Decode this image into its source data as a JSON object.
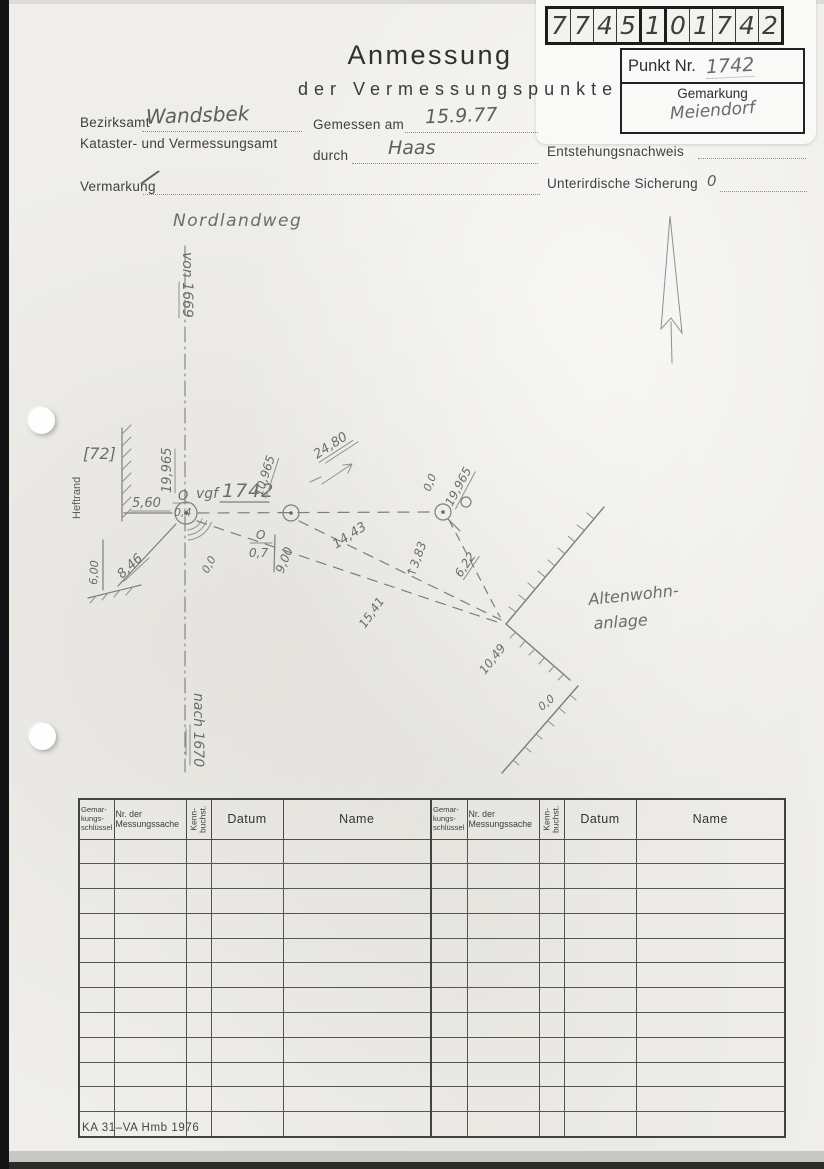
{
  "code_digits": [
    "7",
    "7",
    "4",
    "5",
    "1",
    "0",
    "1",
    "7",
    "4",
    "2"
  ],
  "punkt_box": {
    "label": "Punkt Nr.",
    "value": "1742",
    "gemarkung_label": "Gemarkung",
    "gemarkung_value": "Meiendorf"
  },
  "title": {
    "line1": "Anmessung",
    "line2": "der Vermessungspunkte"
  },
  "form": {
    "bezirksamt_label": "Bezirksamt",
    "bezirksamt_value": "Wandsbek",
    "kataster_label": "Kataster- und Vermessungsamt",
    "gemessen_label": "Gemessen am",
    "gemessen_value": "15.9.77",
    "durch_label": "durch",
    "durch_value": "Haas",
    "entstehung_label": "Entstehungsnachweis",
    "vermarkung_label": "Vermarkung",
    "vermarkung_value": "/",
    "sicherung_label": "Unterirdische Sicherung",
    "sicherung_value": "0"
  },
  "sketch": {
    "street_name": "Nordlandweg",
    "von_label": "von 1669",
    "nach_label": "nach 1670",
    "heftrand": "Heftrand",
    "parcel": "[72]",
    "m19965l": "19,965",
    "m560": "5,60",
    "sym_o1": "O",
    "m04": "0,4",
    "vgf": "vgf",
    "point_no": "1742",
    "m10965": "10,965",
    "m2480": "24,80",
    "sym_o2": "O",
    "m07": "0,7",
    "m900": "9,00",
    "m1443": "14,43",
    "m1541": "15,41",
    "m19965r": "19,965",
    "m00a": "0,0",
    "m383": "↑3,83",
    "m622": "6,22",
    "m1049": "10,49",
    "m00b": "0,0",
    "m600": "6,00",
    "m846": "8,46",
    "m00c": "0,0",
    "area_label_line1": "Altenwohn-",
    "area_label_line2": "anlage"
  },
  "table": {
    "row_count": 12,
    "headers": {
      "gemarkung": "Gemar- kungs- schlüssel",
      "nr": "Nr. der Messungssache",
      "kenn": "Kenn- buchst.",
      "datum": "Datum",
      "name": "Name"
    }
  },
  "footer_code": "KA 31–VA Hmb 1976"
}
